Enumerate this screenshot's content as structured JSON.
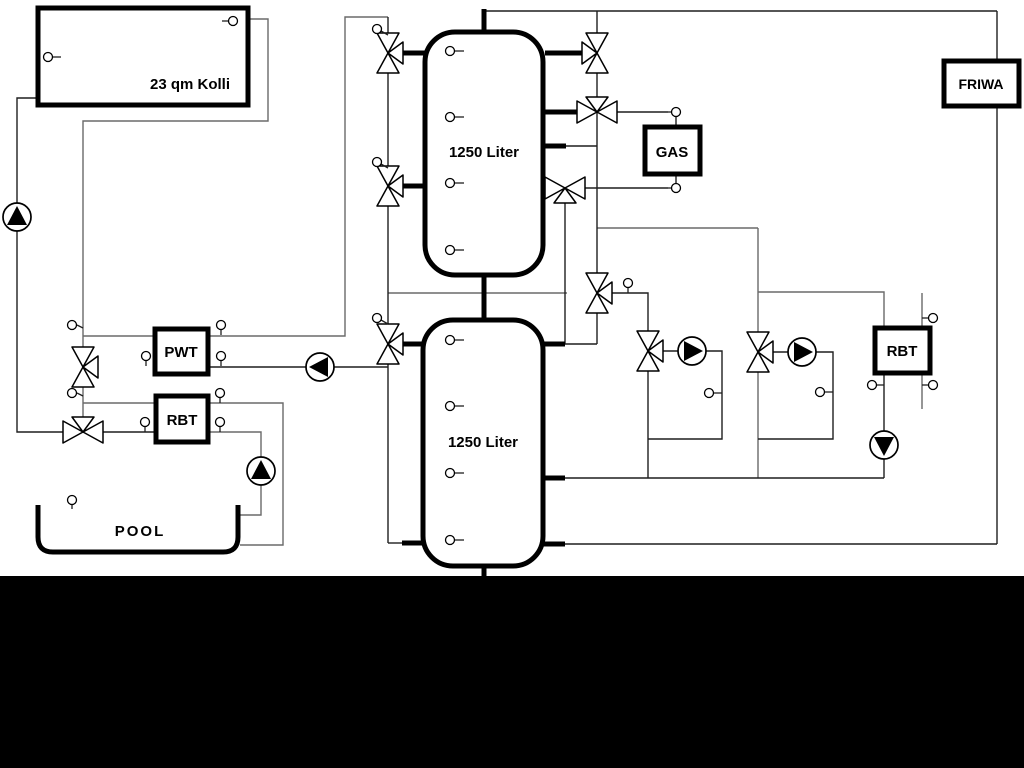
{
  "colors": {
    "background": "#ffffff",
    "footer": "#000000",
    "pipe_gray": "#6a6a6a",
    "pipe_dark": "#1f1f1f",
    "symbol": "#000000"
  },
  "equipment": {
    "collector": {
      "label": "23 qm Kolli"
    },
    "tank_top": {
      "label": "1250 Liter"
    },
    "tank_bottom": {
      "label": "1250 Liter"
    },
    "pwt": {
      "label": "PWT"
    },
    "rbt_pool": {
      "label": "RBT"
    },
    "rbt_right": {
      "label": "RBT"
    },
    "gas": {
      "label": "GAS"
    },
    "friwa": {
      "label": "FRIWA"
    },
    "pool": {
      "label": "POOL"
    }
  }
}
